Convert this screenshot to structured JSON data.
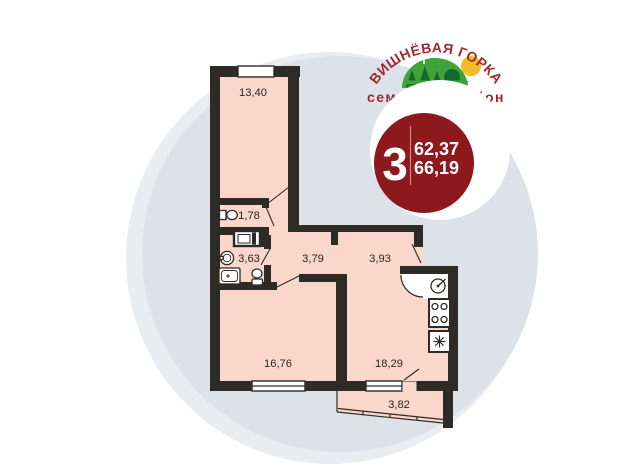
{
  "logo": {
    "title": "ВИШНЁВАЯ ГОРКА",
    "subtitle": "семейный район",
    "colors": {
      "text_red": "#9d2b30",
      "hill_green": "#3fa33a",
      "tree_green": "#15682b",
      "sun_yellow": "#f3bd27"
    }
  },
  "badge": {
    "rooms_count": "3",
    "area_living": "62,37",
    "area_total": "66,19",
    "color": "#8d191d"
  },
  "floor_plan": {
    "rooms": [
      {
        "id": "bedroom",
        "area": "13,40"
      },
      {
        "id": "wc",
        "area": "1,78"
      },
      {
        "id": "bathroom",
        "area": "3,63"
      },
      {
        "id": "hallway",
        "area": "3,79"
      },
      {
        "id": "hall-entry",
        "area": "3,93"
      },
      {
        "id": "living-room",
        "area": "16,76"
      },
      {
        "id": "kitchen-living",
        "area": "18,29"
      },
      {
        "id": "balcony",
        "area": "3,82"
      }
    ],
    "colors": {
      "wall": "#2e2a25",
      "room_fill": "#f9d7ca",
      "background_circle": "#dde2e8"
    }
  }
}
